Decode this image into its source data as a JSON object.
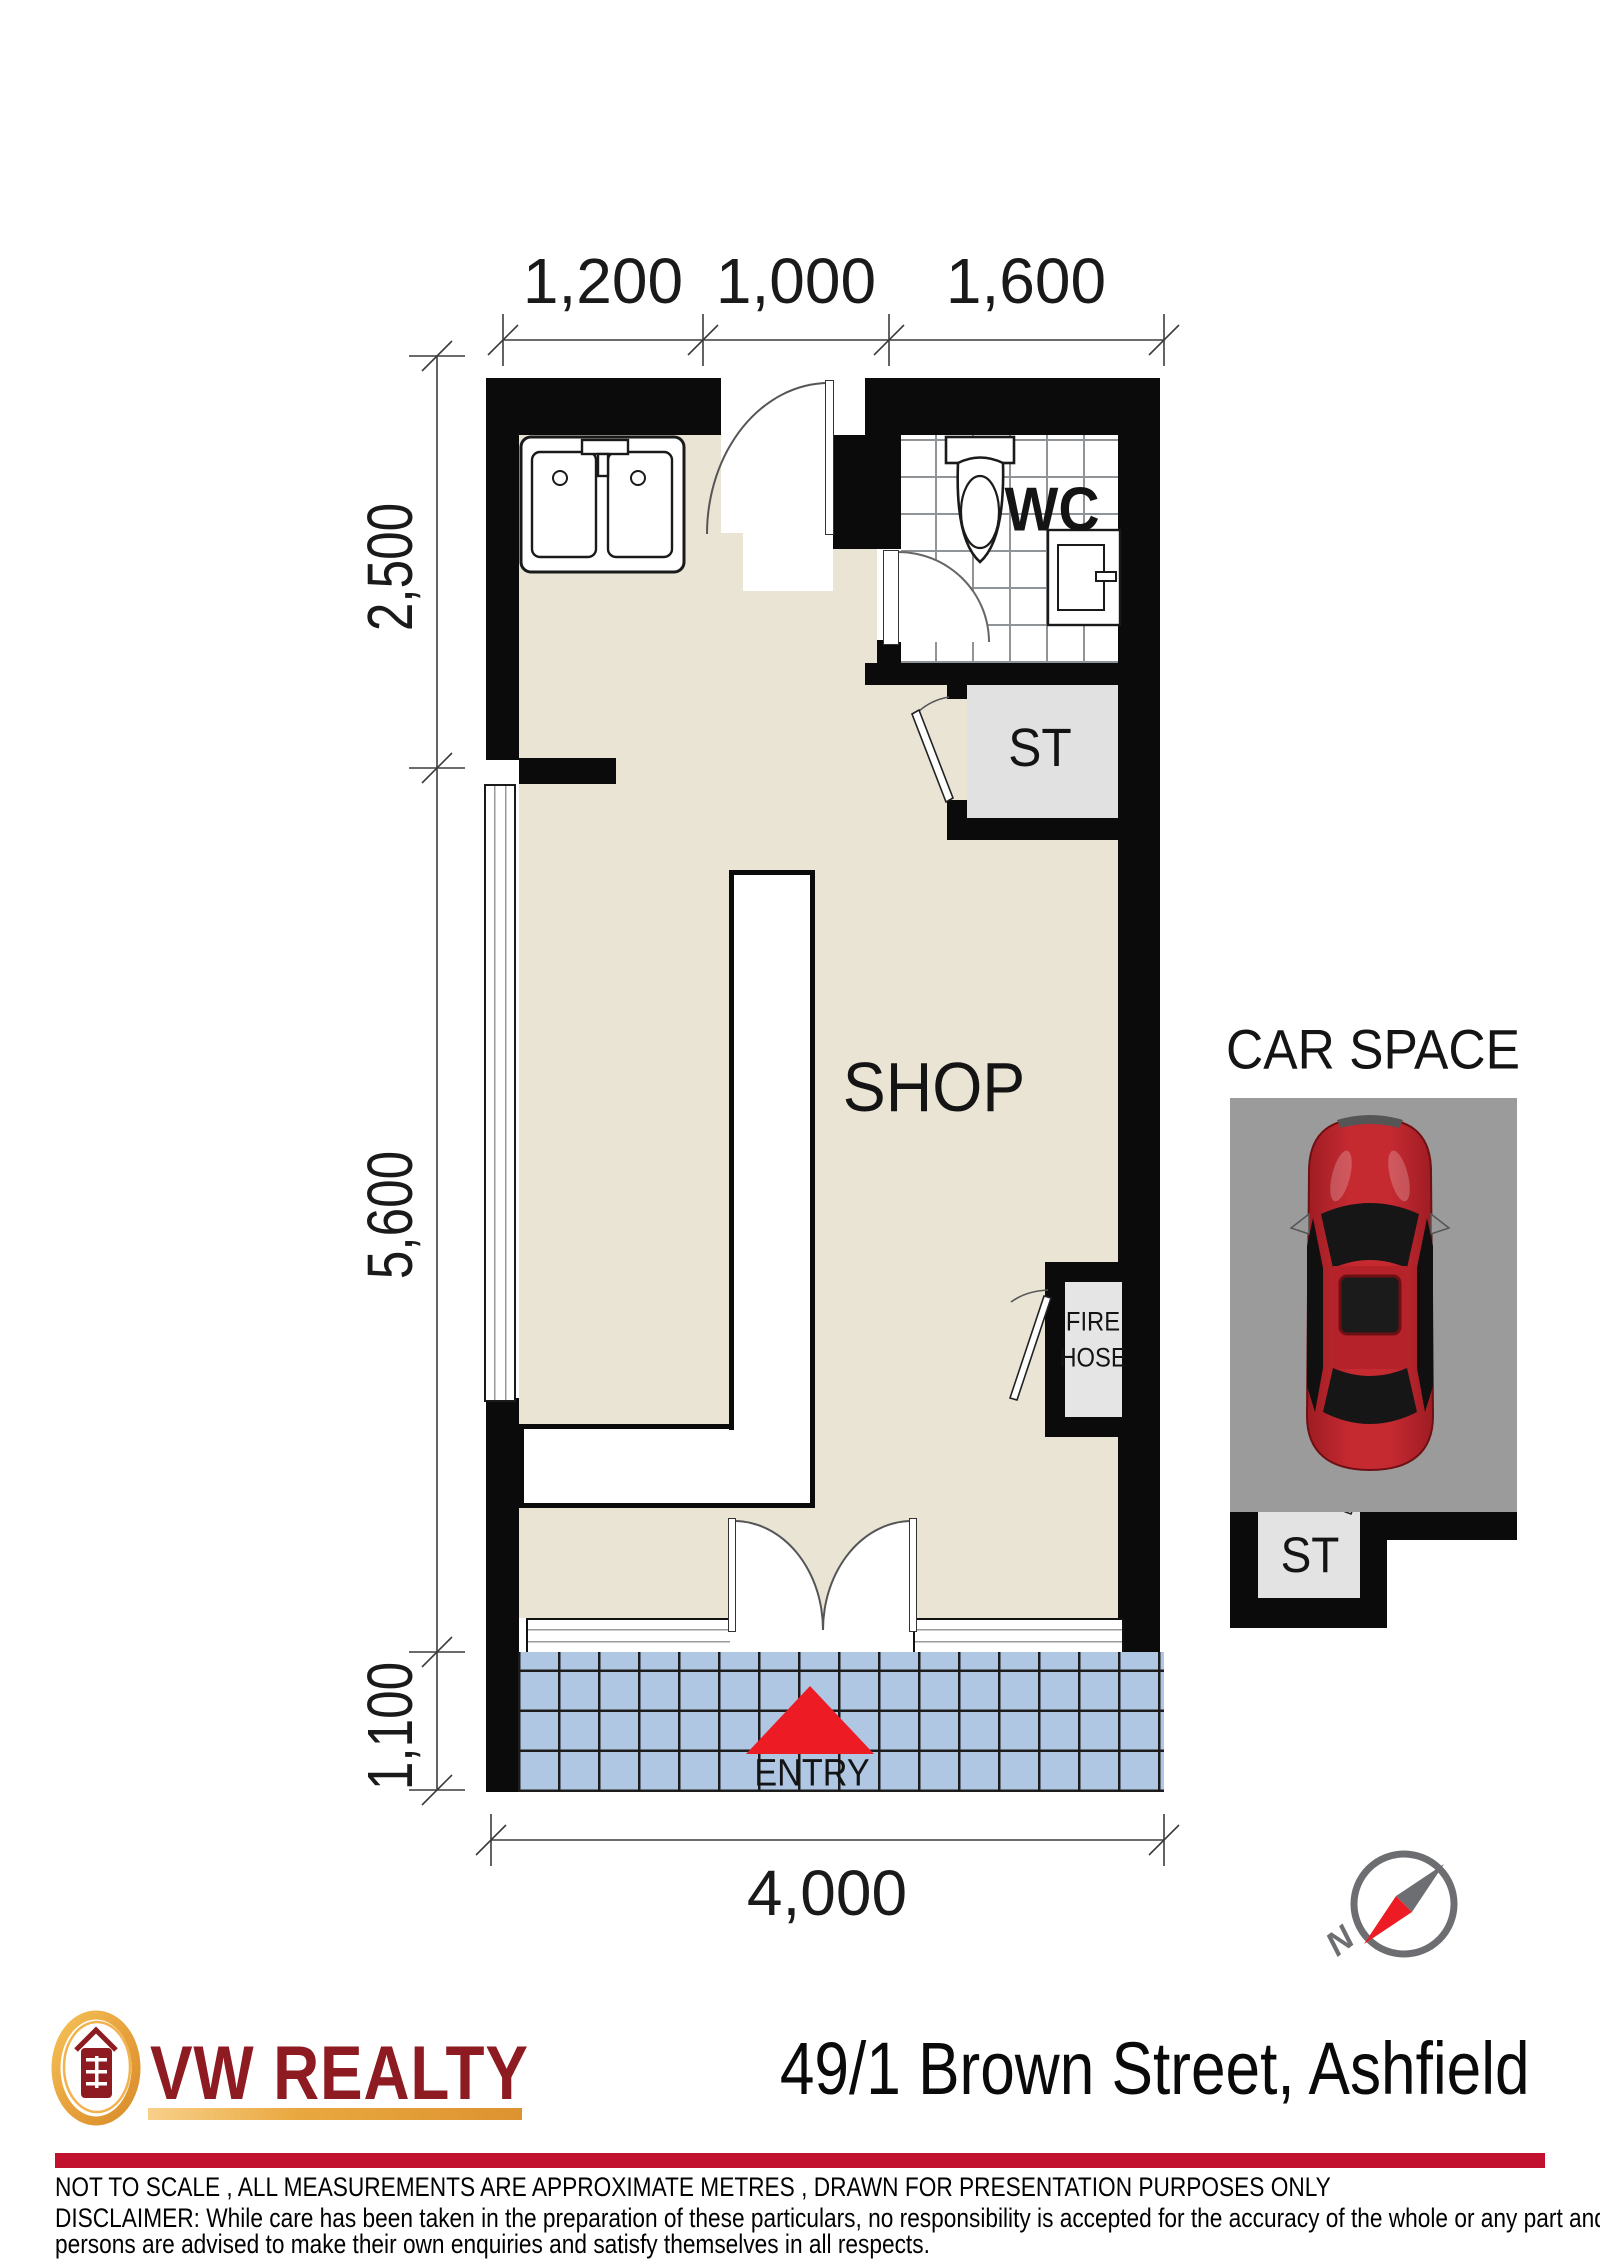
{
  "plan": {
    "dims": {
      "top": [
        "1,200",
        "1,000",
        "1,600"
      ],
      "left": [
        "2,500",
        "5,600",
        "1,100"
      ],
      "bottom": "4,000"
    },
    "labels": {
      "shop": "SHOP",
      "wc": "WC",
      "storage": "ST",
      "fire_line1": "FIRE",
      "fire_line2": "HOSE",
      "entry": "ENTRY"
    }
  },
  "car_space": {
    "title": "CAR SPACE",
    "storage": "ST"
  },
  "compass": {
    "north": "N"
  },
  "branding": {
    "agency": "VW REALTY",
    "address": "49/1 Brown Street, Ashfield"
  },
  "footer": {
    "note": "NOT TO SCALE , ALL MEASUREMENTS ARE APPROXIMATE METRES , DRAWN FOR PRESENTATION PURPOSES ONLY",
    "disclaimer_line1": "DISCLAIMER:  While care has been taken in the preparation of these particulars, no responsibility is accepted for the accuracy of the whole or any part and interested",
    "disclaimer_line2": "persons are advised to make their own enquiries and satisfy  themselves in all respects."
  },
  "colors": {
    "floor": "#EAE4D5",
    "wall": "#0B0B0B",
    "pavement": "#AFC7E3",
    "parking": "#9B9B9B",
    "car_red": "#B5222A",
    "logo_red": "#8D1B21",
    "gold": "#E8A23C",
    "bar_red": "#C2112E",
    "compass_gray": "#6D6E71",
    "needle_red": "#EC1B24"
  }
}
